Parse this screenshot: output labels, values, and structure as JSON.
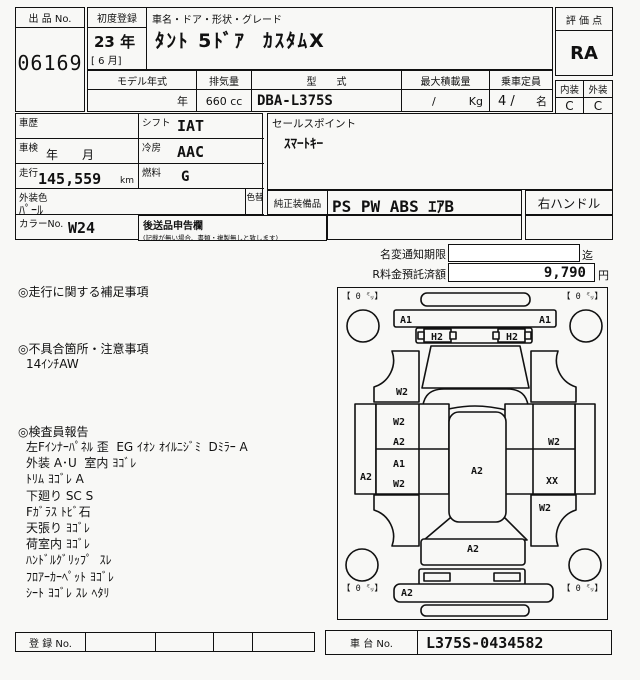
{
  "header": {
    "auction_no_label": "出 品 No.",
    "auction_no": "06169",
    "first_reg_label": "初度登録",
    "first_reg_year": "23 年",
    "first_reg_month": "[ 6 月]",
    "car_name_label": "車名・ドア・形状・グレード",
    "car_name": "ﾀﾝﾄ 5ﾄﾞｱ  ｶｽﾀﾑX",
    "grade_label": "評 価 点",
    "grade": "RA",
    "interior_label": "内装",
    "exterior_label": "外装",
    "interior_grade": "C",
    "exterior_grade": "C",
    "spec_headers": {
      "model_year": "モデル年式",
      "displacement": "排気量",
      "model_code": "型　　式",
      "max_load": "最大積載量",
      "capacity": "乗車定員"
    },
    "spec_values": {
      "model_year": "年",
      "displacement": "660 cc",
      "model_code": "DBA-L375S",
      "max_load_slash": "/",
      "max_load_unit": "Kg",
      "capacity": "4 /",
      "capacity_unit": "名"
    }
  },
  "details": {
    "history_label": "車歴",
    "history": "",
    "shift_label": "シフト",
    "shift": "IAT",
    "inspection_label": "車検",
    "inspection": "年　　月",
    "ac_label": "冷房",
    "ac": "AAC",
    "mileage_label": "走行",
    "mileage": "145,559",
    "mileage_unit": "km",
    "fuel_label": "燃料",
    "fuel": "G",
    "color_label": "外装色",
    "color": "ﾊﾟｰﾙ",
    "recolor_label": "色替",
    "color_no_label": "カラーNo.",
    "color_no": "W24",
    "later_doc_label": "後送品申告欄",
    "later_doc_note": "(記載が無い場合、書類・複製無しと致します)",
    "sales_point_label": "セールスポイント",
    "sales_point": "ｽﾏｰﾄｷｰ",
    "equipment_label": "純正装備品",
    "equipment": "PS PW ABS ｴｱB",
    "handle": "右ハンドル"
  },
  "notice": {
    "name_change_label": "名変通知期限",
    "name_change_value": "",
    "name_change_suffix": "迄",
    "recycle_label": "R料金預託済額",
    "recycle_value": "9,790",
    "recycle_suffix": "円"
  },
  "notes": {
    "mileage_note_label": "◎走行に関する補足事項",
    "defect_label": "◎不具合箇所・注意事項",
    "defect_lines": [
      "14ｲﾝﾁAW"
    ],
    "inspector_label": "◎検査員報告",
    "inspector_lines": [
      "左Fｲﾝﾅｰﾊﾟﾈﾙ 歪  EG ｲｵﾝ ｵｲﾙﾆｼﾞﾐ  Dﾐﾗｰ A",
      "外装 A･U  室内 ﾖｺﾞﾚ",
      "ﾄﾘﾑ ﾖｺﾞﾚ A",
      "下廻り SC S",
      "Fｶﾞﾗｽ ﾄﾋﾞ石",
      "天張り ﾖｺﾞﾚ",
      "荷室内 ﾖｺﾞﾚ",
      "ﾊﾝﾄﾞﾙｸﾞﾘｯﾌﾟ  ｽﾚ",
      "ﾌﾛｱｰｶｰﾍﾟｯﾄ ﾖｺﾞﾚ",
      "ｼｰﾄ ﾖｺﾞﾚ ｽﾚ ﾍﾀﾘ"
    ]
  },
  "footer": {
    "reg_no_label": "登 録 No.",
    "chassis_label": "車 台 No.",
    "chassis_no": "L375S-0434582"
  },
  "diagram": {
    "corner_labels": [
      {
        "text": "【 0 ㍉】",
        "x": 4,
        "y": 11
      },
      {
        "text": "【 0 ㍉】",
        "x": 224,
        "y": 11
      },
      {
        "text": "【 0 ㍉】",
        "x": 4,
        "y": 303
      },
      {
        "text": "【 0 ㍉】",
        "x": 224,
        "y": 303
      }
    ],
    "damage_labels": [
      {
        "text": "A1",
        "x": 68,
        "y": 35
      },
      {
        "text": "A1",
        "x": 207,
        "y": 35
      },
      {
        "text": "H2",
        "x": 99,
        "y": 52
      },
      {
        "text": "H2",
        "x": 174,
        "y": 52
      },
      {
        "text": "W2",
        "x": 64,
        "y": 107
      },
      {
        "text": "W2",
        "x": 61,
        "y": 137
      },
      {
        "text": "A2",
        "x": 61,
        "y": 157
      },
      {
        "text": "A1",
        "x": 61,
        "y": 179
      },
      {
        "text": "W2",
        "x": 61,
        "y": 199
      },
      {
        "text": "A2",
        "x": 28,
        "y": 192
      },
      {
        "text": "A2",
        "x": 139,
        "y": 186
      },
      {
        "text": "W2",
        "x": 216,
        "y": 157
      },
      {
        "text": "XX",
        "x": 214,
        "y": 196
      },
      {
        "text": "W2",
        "x": 207,
        "y": 223
      },
      {
        "text": "A2",
        "x": 135,
        "y": 264
      },
      {
        "text": "A2",
        "x": 69,
        "y": 308
      }
    ]
  }
}
